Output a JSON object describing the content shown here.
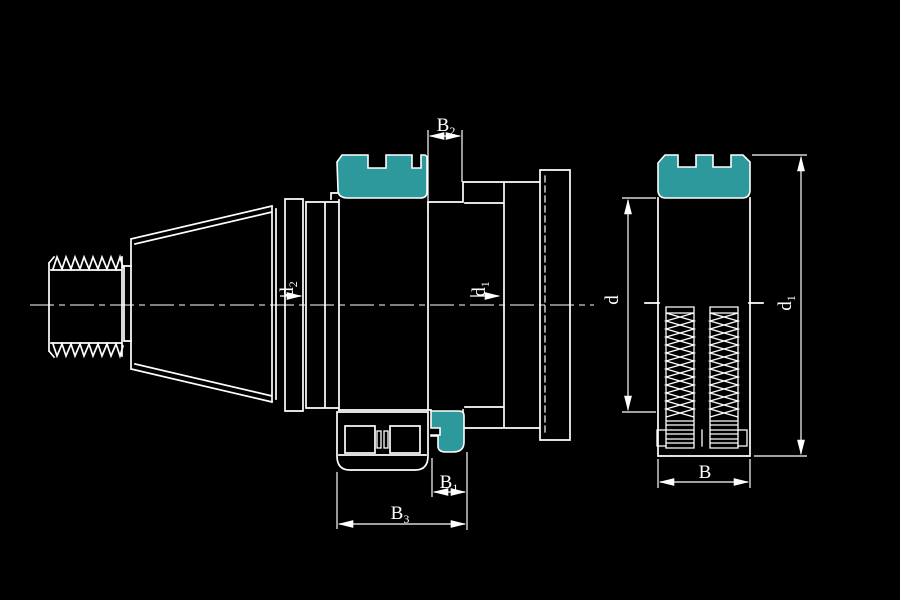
{
  "colors": {
    "background": "#000000",
    "line": "#ffffff",
    "highlight": "#2e999c"
  },
  "dimensions": {
    "b2": {
      "main": "B",
      "sub": "2"
    },
    "b1": {
      "main": "B",
      "sub": "1"
    },
    "b3": {
      "main": "B",
      "sub": "3"
    },
    "b_side": {
      "main": "B",
      "sub": ""
    },
    "d2_front": {
      "main": "d",
      "sub": "2"
    },
    "d1_front": {
      "main": "d",
      "sub": "1"
    },
    "d_side": {
      "main": "d",
      "sub": ""
    },
    "d1_side": {
      "main": "d",
      "sub": "1"
    }
  }
}
